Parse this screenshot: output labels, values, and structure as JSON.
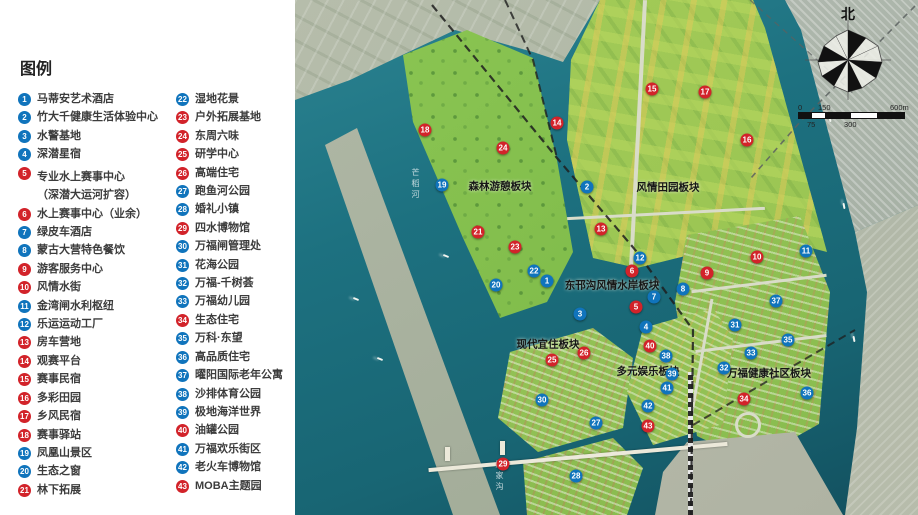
{
  "legend": {
    "title": "图例",
    "items": [
      {
        "num": 1,
        "label": "马蒂安艺术酒店",
        "color": "blue"
      },
      {
        "num": 2,
        "label": "竹大千健康生活体验中心",
        "color": "blue"
      },
      {
        "num": 3,
        "label": "水警基地",
        "color": "blue"
      },
      {
        "num": 4,
        "label": "深潜星宿",
        "color": "blue"
      },
      {
        "num": 5,
        "label": "专业水上赛事中心",
        "sub": "（深潜大运河扩容）",
        "color": "red"
      },
      {
        "num": 6,
        "label": "水上赛事中心（业余）",
        "color": "red"
      },
      {
        "num": 7,
        "label": "绿皮车酒店",
        "color": "blue"
      },
      {
        "num": 8,
        "label": "蒙古大营特色餐饮",
        "color": "blue"
      },
      {
        "num": 9,
        "label": "游客服务中心",
        "color": "red"
      },
      {
        "num": 10,
        "label": "风情水街",
        "color": "red"
      },
      {
        "num": 11,
        "label": "金湾闸水利枢纽",
        "color": "blue"
      },
      {
        "num": 12,
        "label": "乐运运动工厂",
        "color": "blue"
      },
      {
        "num": 13,
        "label": "房车营地",
        "color": "red"
      },
      {
        "num": 14,
        "label": "观赛平台",
        "color": "red"
      },
      {
        "num": 15,
        "label": "赛事民宿",
        "color": "red"
      },
      {
        "num": 16,
        "label": "多彩田园",
        "color": "red"
      },
      {
        "num": 17,
        "label": "乡风民宿",
        "color": "red"
      },
      {
        "num": 18,
        "label": "赛事驿站",
        "color": "red"
      },
      {
        "num": 19,
        "label": "凤凰山景区",
        "color": "blue"
      },
      {
        "num": 20,
        "label": "生态之窗",
        "color": "blue"
      },
      {
        "num": 21,
        "label": "林下拓展",
        "color": "red"
      },
      {
        "num": 22,
        "label": "湿地花景",
        "color": "blue"
      },
      {
        "num": 23,
        "label": "户外拓展基地",
        "color": "red"
      },
      {
        "num": 24,
        "label": "东周六味",
        "color": "red"
      },
      {
        "num": 25,
        "label": "研学中心",
        "color": "red"
      },
      {
        "num": 26,
        "label": "高端住宅",
        "color": "red"
      },
      {
        "num": 27,
        "label": "跑鱼河公园",
        "color": "blue"
      },
      {
        "num": 28,
        "label": "婚礼小镇",
        "color": "blue"
      },
      {
        "num": 29,
        "label": "四水博物馆",
        "color": "red"
      },
      {
        "num": 30,
        "label": "万福闸管理处",
        "color": "blue"
      },
      {
        "num": 31,
        "label": "花海公园",
        "color": "blue"
      },
      {
        "num": 32,
        "label": "万福-千树荟",
        "color": "blue"
      },
      {
        "num": 33,
        "label": "万福幼儿园",
        "color": "blue"
      },
      {
        "num": 34,
        "label": "生态住宅",
        "color": "red"
      },
      {
        "num": 35,
        "label": "万科·东望",
        "color": "blue"
      },
      {
        "num": 36,
        "label": "高品质住宅",
        "color": "blue"
      },
      {
        "num": 37,
        "label": "曜阳国际老年公寓",
        "color": "blue"
      },
      {
        "num": 38,
        "label": "沙排体育公园",
        "color": "blue"
      },
      {
        "num": 39,
        "label": "极地海洋世界",
        "color": "blue"
      },
      {
        "num": 40,
        "label": "油罐公园",
        "color": "red"
      },
      {
        "num": 41,
        "label": "万福欢乐街区",
        "color": "blue"
      },
      {
        "num": 42,
        "label": "老火车博物馆",
        "color": "blue"
      },
      {
        "num": 43,
        "label": "MOBA主题园",
        "color": "red"
      }
    ],
    "colors": {
      "blue": "#1074bc",
      "red": "#d2232a"
    }
  },
  "map": {
    "block_labels": [
      {
        "text": "森林游憩板块",
        "x": 500,
        "y": 186
      },
      {
        "text": "风情田园板块",
        "x": 668,
        "y": 187
      },
      {
        "text": "东邗沟风情水岸板块",
        "x": 612,
        "y": 285
      },
      {
        "text": "现代宜住板块",
        "x": 548,
        "y": 344
      },
      {
        "text": "多元娱乐板块",
        "x": 648,
        "y": 371
      },
      {
        "text": "万福健康社区板块",
        "x": 769,
        "y": 373
      }
    ],
    "river_labels": [
      {
        "text": "芒稻河",
        "x": 410,
        "y": 168
      },
      {
        "text": "廖家沟",
        "x": 494,
        "y": 460
      }
    ],
    "markers": [
      [
        1,
        547,
        281
      ],
      [
        2,
        587,
        187
      ],
      [
        3,
        580,
        314
      ],
      [
        4,
        646,
        327
      ],
      [
        5,
        636,
        307
      ],
      [
        6,
        632,
        271
      ],
      [
        7,
        654,
        297
      ],
      [
        8,
        683,
        289
      ],
      [
        9,
        707,
        273
      ],
      [
        10,
        757,
        257
      ],
      [
        11,
        806,
        251
      ],
      [
        12,
        640,
        258
      ],
      [
        13,
        601,
        229
      ],
      [
        14,
        557,
        123
      ],
      [
        15,
        652,
        89
      ],
      [
        16,
        747,
        140
      ],
      [
        17,
        705,
        92
      ],
      [
        18,
        425,
        130
      ],
      [
        19,
        442,
        185
      ],
      [
        20,
        496,
        285
      ],
      [
        21,
        478,
        232
      ],
      [
        22,
        534,
        271
      ],
      [
        23,
        515,
        247
      ],
      [
        24,
        503,
        148
      ],
      [
        25,
        552,
        360
      ],
      [
        26,
        584,
        353
      ],
      [
        27,
        596,
        423
      ],
      [
        28,
        576,
        476
      ],
      [
        29,
        503,
        464
      ],
      [
        30,
        542,
        400
      ],
      [
        31,
        735,
        325
      ],
      [
        32,
        724,
        368
      ],
      [
        33,
        751,
        353
      ],
      [
        34,
        744,
        399
      ],
      [
        35,
        788,
        340
      ],
      [
        36,
        807,
        393
      ],
      [
        37,
        776,
        301
      ],
      [
        38,
        666,
        356
      ],
      [
        39,
        672,
        374
      ],
      [
        40,
        650,
        346
      ],
      [
        41,
        667,
        388
      ],
      [
        42,
        648,
        406
      ],
      [
        43,
        648,
        426
      ]
    ],
    "compass": {
      "north_label": "北"
    },
    "scale": {
      "top_labels": [
        {
          "text": "0",
          "x": 0
        },
        {
          "text": "150",
          "x": 20
        },
        {
          "text": "600m",
          "x": 92
        }
      ],
      "bottom_labels": [
        {
          "text": "75",
          "x": 9
        },
        {
          "text": "300",
          "x": 46
        }
      ]
    }
  }
}
